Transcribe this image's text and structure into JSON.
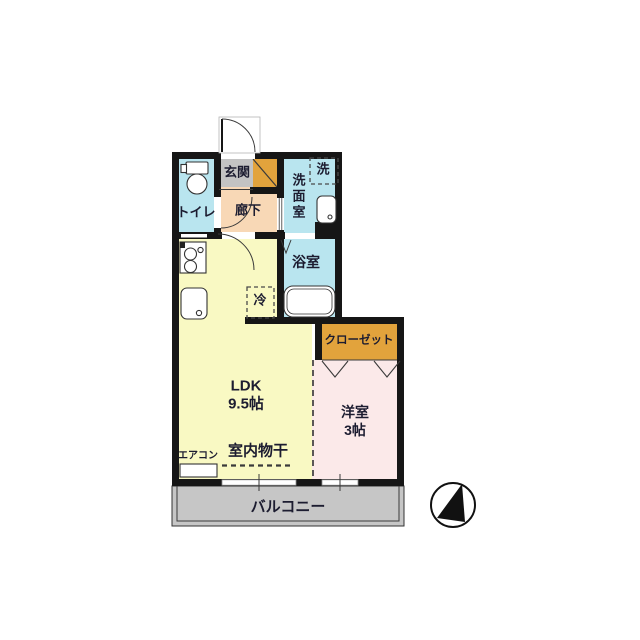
{
  "plan": {
    "rooms": {
      "genkan": {
        "label": "玄関"
      },
      "toilet": {
        "label": "トイレ"
      },
      "hallway": {
        "label": "廊下"
      },
      "washroom": {
        "label": "洗面室"
      },
      "washer_space": {
        "label": "洗"
      },
      "bathroom": {
        "label": "浴室"
      },
      "refrigerator_space": {
        "label": "冷"
      },
      "ldk": {
        "label": "LDK",
        "size": "9.5帖"
      },
      "closet": {
        "label": "クローゼット"
      },
      "western_room": {
        "label": "洋室",
        "size": "3帖"
      },
      "balcony": {
        "label": "バルコニー"
      }
    },
    "features": {
      "indoor_drying": {
        "label": "室内物干"
      },
      "aircon": {
        "label": "エアコン"
      }
    },
    "icons": [
      "entry-door-arc",
      "toilet-icon",
      "stove-icon",
      "kitchen-sink-icon",
      "vanity-sink-icon",
      "bathtub-icon",
      "folding-bath-door-icon",
      "closet-bifold-door-icon",
      "sliding-window-icon",
      "compass-north-icon"
    ],
    "colors": {
      "wet_area": "#b9e5ef",
      "genkan_tile": "#c3c3c3",
      "hallway": "#f8d8b6",
      "ldk": "#f9f9c3",
      "western_room": "#fbe9e9",
      "closet": "#e2a33c",
      "balcony": "#c6c6c6",
      "wall": "#161616",
      "text": "#1c1c30"
    }
  }
}
